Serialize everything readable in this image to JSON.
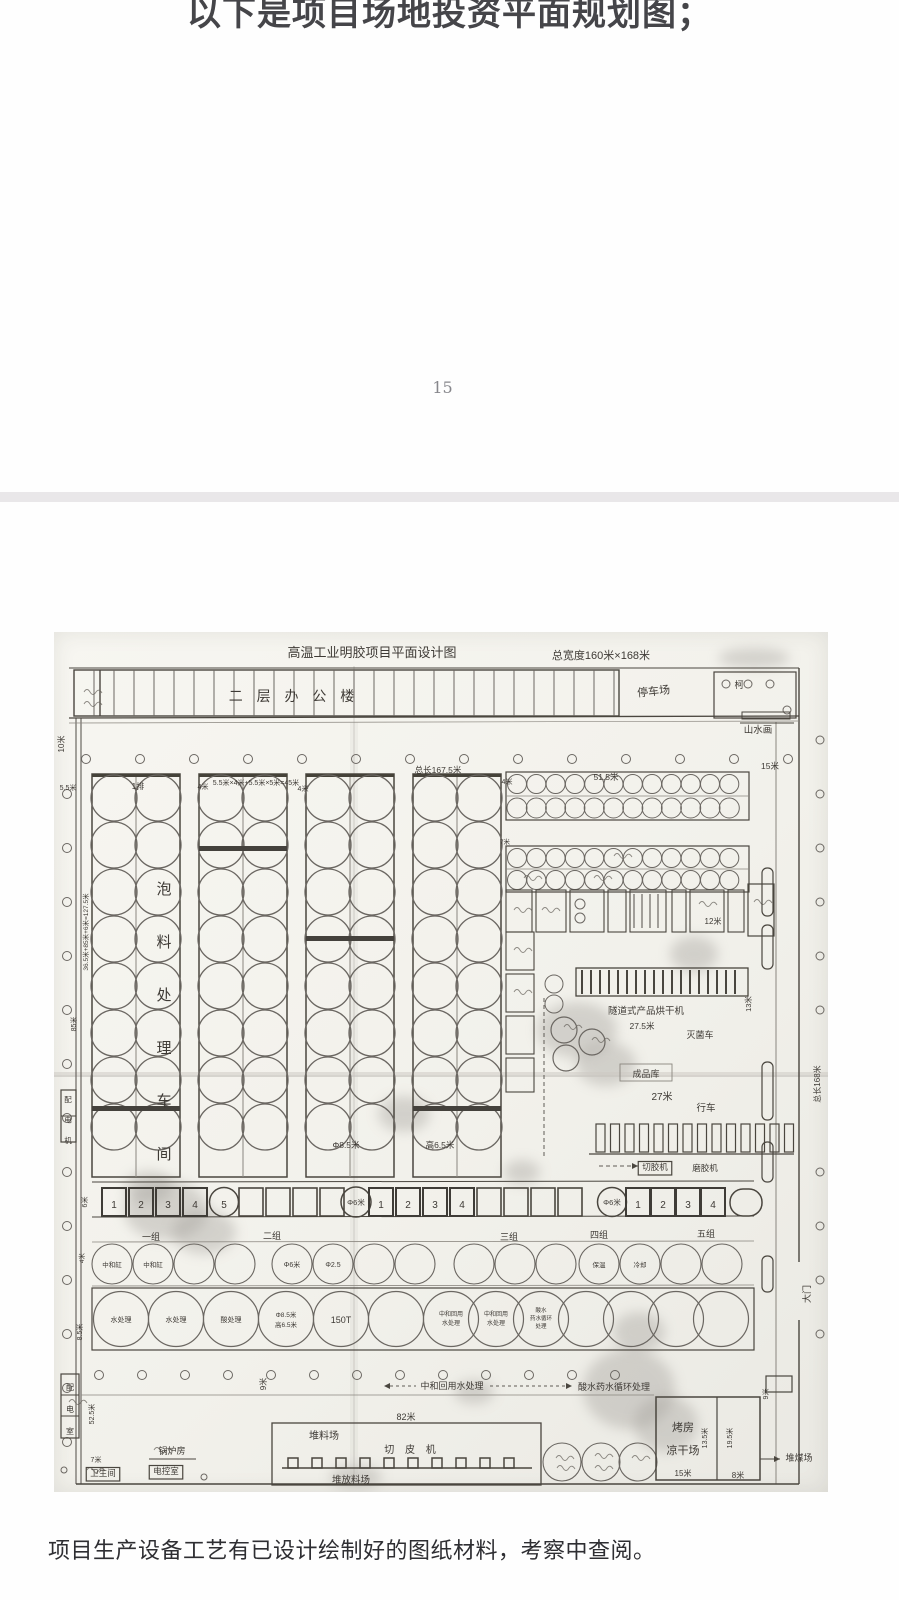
{
  "page1": {
    "heading": "以下是项目场地投资平面规划图；",
    "page_number": "15"
  },
  "page2": {
    "caption": "项目生产设备工艺有已设计绘制好的图纸材料，考察中查阅。"
  },
  "colors": {
    "paper": "#f4f3ee",
    "ink": "#4a463f",
    "divider": "#e9e7e9",
    "heading_text": "#454549"
  },
  "blueprint": {
    "title": "高温工业明胶项目平面设计图",
    "title_dimension": "总宽度160米×168米",
    "labels": [
      {
        "t": "高温工业明胶项目平面设计图",
        "x": 318,
        "y": 25,
        "s": 13
      },
      {
        "t": "总宽度160米×168米",
        "x": 547,
        "y": 27,
        "s": 11
      },
      {
        "t": "二 层 办 公 楼",
        "x": 240,
        "y": 69,
        "s": 14,
        "ls": 5
      },
      {
        "t": "停车场",
        "x": 600,
        "y": 63,
        "s": 11,
        "r": -6
      },
      {
        "t": "柯",
        "x": 685,
        "y": 56,
        "s": 9
      },
      {
        "t": "山水画",
        "x": 704,
        "y": 101,
        "s": 9.5
      },
      {
        "t": "10米",
        "x": 10,
        "y": 112,
        "s": 8,
        "r": -90
      },
      {
        "t": "5.5米",
        "x": 14,
        "y": 158,
        "s": 7
      },
      {
        "t": "1排",
        "x": 84,
        "y": 157,
        "s": 8
      },
      {
        "t": "4米",
        "x": 149,
        "y": 157,
        "s": 7
      },
      {
        "t": "5.5米×4米+5.5米×5米=45米",
        "x": 202,
        "y": 153,
        "s": 7
      },
      {
        "t": "4米",
        "x": 249,
        "y": 159,
        "s": 7
      },
      {
        "t": "总长167.5米",
        "x": 384,
        "y": 141,
        "s": 8.5
      },
      {
        "t": "4米",
        "x": 453,
        "y": 152,
        "s": 7
      },
      {
        "t": "51.5米",
        "x": 552,
        "y": 148,
        "s": 8.5
      },
      {
        "t": "15米",
        "x": 716,
        "y": 137,
        "s": 8.5
      },
      {
        "t": "7米",
        "x": 451,
        "y": 212,
        "s": 6.5
      },
      {
        "t": "36.5米+85米+6米=127.5米",
        "x": 34,
        "y": 300,
        "s": 6.5,
        "r": -90
      },
      {
        "t": "85米",
        "x": 22,
        "y": 392,
        "s": 7,
        "r": -90
      },
      {
        "t": "泡料处理车间",
        "x": 110,
        "y": 262,
        "s": 15,
        "v": 38
      },
      {
        "t": "Φ8.5米",
        "x": 292,
        "y": 516,
        "s": 8.5
      },
      {
        "t": "高6.5米",
        "x": 386,
        "y": 516,
        "s": 8.5
      },
      {
        "t": "12米",
        "x": 659,
        "y": 292,
        "s": 8
      },
      {
        "t": "13米",
        "x": 697,
        "y": 372,
        "s": 7.5,
        "r": -90
      },
      {
        "t": "隧道式产品烘干机",
        "x": 592,
        "y": 382,
        "s": 9.5
      },
      {
        "t": "27.5米",
        "x": 588,
        "y": 397,
        "s": 8.5
      },
      {
        "t": "灭菌车",
        "x": 646,
        "y": 406,
        "s": 9
      },
      {
        "t": "成品库",
        "x": 592,
        "y": 445,
        "s": 9
      },
      {
        "t": "27米",
        "x": 608,
        "y": 468,
        "s": 10
      },
      {
        "t": "行车",
        "x": 652,
        "y": 479,
        "s": 9.5
      },
      {
        "t": "切胶机",
        "x": 601,
        "y": 538,
        "s": 8.5,
        "b": 1
      },
      {
        "t": "磨胶机",
        "x": 651,
        "y": 539,
        "s": 8.5
      },
      {
        "t": "总长168米",
        "x": 766,
        "y": 452,
        "s": 8,
        "r": -90
      },
      {
        "t": "大门",
        "x": 756,
        "y": 662,
        "s": 9,
        "r": -90
      },
      {
        "t": "6米",
        "x": 33,
        "y": 570,
        "s": 7,
        "r": -90
      },
      {
        "t": "1",
        "x": 60,
        "y": 576,
        "s": 10
      },
      {
        "t": "2",
        "x": 87,
        "y": 576,
        "s": 10
      },
      {
        "t": "3",
        "x": 114,
        "y": 576,
        "s": 10
      },
      {
        "t": "4",
        "x": 141,
        "y": 576,
        "s": 10
      },
      {
        "t": "5",
        "x": 170,
        "y": 576,
        "s": 10
      },
      {
        "t": "Φ6米",
        "x": 302,
        "y": 573,
        "s": 7.5
      },
      {
        "t": "1",
        "x": 327,
        "y": 576,
        "s": 10
      },
      {
        "t": "2",
        "x": 354,
        "y": 576,
        "s": 10
      },
      {
        "t": "3",
        "x": 381,
        "y": 576,
        "s": 10
      },
      {
        "t": "4",
        "x": 408,
        "y": 576,
        "s": 10
      },
      {
        "t": "Φ6米",
        "x": 558,
        "y": 573,
        "s": 7.5
      },
      {
        "t": "1",
        "x": 584,
        "y": 576,
        "s": 10
      },
      {
        "t": "2",
        "x": 609,
        "y": 576,
        "s": 10
      },
      {
        "t": "3",
        "x": 634,
        "y": 576,
        "s": 10
      },
      {
        "t": "4",
        "x": 659,
        "y": 576,
        "s": 10
      },
      {
        "t": "一组",
        "x": 97,
        "y": 608,
        "s": 9
      },
      {
        "t": "二组",
        "x": 218,
        "y": 607,
        "s": 9
      },
      {
        "t": "三组",
        "x": 455,
        "y": 608,
        "s": 9
      },
      {
        "t": "四组",
        "x": 545,
        "y": 606,
        "s": 9
      },
      {
        "t": "五组",
        "x": 652,
        "y": 605,
        "s": 9
      },
      {
        "t": "中和缸",
        "x": 58,
        "y": 635,
        "s": 6.5
      },
      {
        "t": "中和缸",
        "x": 99,
        "y": 635,
        "s": 6.5
      },
      {
        "t": "Φ6米",
        "x": 238,
        "y": 635,
        "s": 7
      },
      {
        "t": "Φ2.5",
        "x": 279,
        "y": 635,
        "s": 7
      },
      {
        "t": "保温",
        "x": 545,
        "y": 635,
        "s": 6.5
      },
      {
        "t": "冷却",
        "x": 586,
        "y": 635,
        "s": 6.5
      },
      {
        "t": "水处理",
        "x": 67,
        "y": 690,
        "s": 7
      },
      {
        "t": "水处理",
        "x": 122,
        "y": 690,
        "s": 7
      },
      {
        "t": "酸处理",
        "x": 177,
        "y": 690,
        "s": 7
      },
      {
        "t": "Φ8.5米",
        "x": 232,
        "y": 685,
        "s": 6.5
      },
      {
        "t": "高6.5米",
        "x": 232,
        "y": 695,
        "s": 6.5
      },
      {
        "t": "150T",
        "x": 287,
        "y": 691,
        "s": 9
      },
      {
        "t": "中和回用",
        "x": 397,
        "y": 684,
        "s": 6
      },
      {
        "t": "水处理",
        "x": 397,
        "y": 693,
        "s": 6
      },
      {
        "t": "中和回用",
        "x": 442,
        "y": 684,
        "s": 6
      },
      {
        "t": "水处理",
        "x": 442,
        "y": 693,
        "s": 6
      },
      {
        "t": "酸水",
        "x": 487,
        "y": 680,
        "s": 5.5
      },
      {
        "t": "药水循环",
        "x": 487,
        "y": 688,
        "s": 5.5
      },
      {
        "t": "处理",
        "x": 487,
        "y": 696,
        "s": 5.5
      },
      {
        "t": "9米",
        "x": 212,
        "y": 752,
        "s": 8,
        "r": -90
      },
      {
        "t": "8.5米",
        "x": 28,
        "y": 700,
        "s": 7,
        "r": -90
      },
      {
        "t": "4米",
        "x": 30,
        "y": 626,
        "s": 6.5,
        "r": -90
      },
      {
        "t": "中和回用水处理",
        "x": 398,
        "y": 757,
        "s": 9
      },
      {
        "t": "酸水药水循环处理",
        "x": 560,
        "y": 758,
        "s": 9
      },
      {
        "t": "52.5米",
        "x": 40,
        "y": 782,
        "s": 7,
        "r": -90
      },
      {
        "t": "锅炉房",
        "x": 118,
        "y": 822,
        "s": 9
      },
      {
        "t": "卫生间",
        "x": 49,
        "y": 844,
        "s": 8.5,
        "b": 1
      },
      {
        "t": "电控室",
        "x": 112,
        "y": 842,
        "s": 8.5,
        "b": 1
      },
      {
        "t": "7米",
        "x": 42,
        "y": 830,
        "s": 7
      },
      {
        "t": "82米",
        "x": 352,
        "y": 788,
        "s": 9
      },
      {
        "t": "堆料场",
        "x": 270,
        "y": 807,
        "s": 10
      },
      {
        "t": "切 皮 机",
        "x": 358,
        "y": 821,
        "s": 10,
        "ls": 4
      },
      {
        "t": "堆放料场",
        "x": 297,
        "y": 851,
        "s": 9.5
      },
      {
        "t": "烤房",
        "x": 629,
        "y": 799,
        "s": 11
      },
      {
        "t": "凉干场",
        "x": 629,
        "y": 822,
        "s": 11
      },
      {
        "t": "13.5米",
        "x": 653,
        "y": 806,
        "s": 7,
        "r": -90
      },
      {
        "t": "19.5米",
        "x": 678,
        "y": 806,
        "s": 7,
        "r": -90
      },
      {
        "t": "15米",
        "x": 629,
        "y": 844,
        "s": 8
      },
      {
        "t": "8米",
        "x": 684,
        "y": 846,
        "s": 8
      },
      {
        "t": "堆煤场",
        "x": 745,
        "y": 829,
        "s": 9
      },
      {
        "t": "9米",
        "x": 714,
        "y": 762,
        "s": 7,
        "r": -90
      },
      {
        "t": "配电机",
        "x": 14,
        "y": 470,
        "s": 7.5,
        "v": 13
      },
      {
        "t": "配电室",
        "x": 16,
        "y": 758,
        "s": 8,
        "v": 14
      }
    ]
  }
}
